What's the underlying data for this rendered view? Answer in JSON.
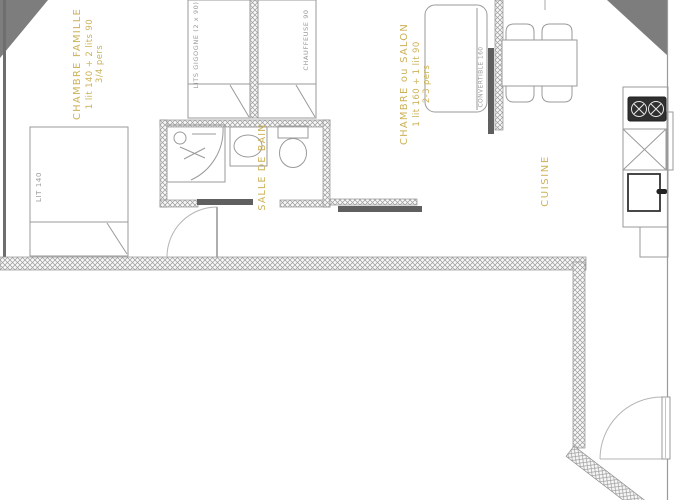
{
  "plan": {
    "title": "apartment-floor-plan",
    "rooms": {
      "chambre_famille": {
        "name": "CHAMBRE FAMILLE",
        "detail": "1 lit 140 + 2 lits 90",
        "capacity": "3/4 pers"
      },
      "salle_de_bain": {
        "name": "SALLE DE BAIN"
      },
      "chambre_salon": {
        "name": "CHAMBRE ou SALON",
        "detail": "1 lit 160 + 1 lit 90",
        "capacity": "2-3 pers"
      },
      "cuisine": {
        "name": "CUISINE"
      }
    },
    "furniture": {
      "lit_140": "LIT 140",
      "lits_gigogne": "LITS GIGOGNE (2 x 90)",
      "chauffeuse": "CHAUFFEUSE 90",
      "convertible": "CONVERTIBLE 160"
    },
    "colors": {
      "room_label": "#cdb257",
      "furniture_label": "#9a9a9a",
      "wall_hatch": "#9b9b9b",
      "outline": "#999999",
      "dark_bar": "#5f5f5f",
      "corner_triangle": "#7d7d7d",
      "stove": "#2f2f2f"
    }
  }
}
